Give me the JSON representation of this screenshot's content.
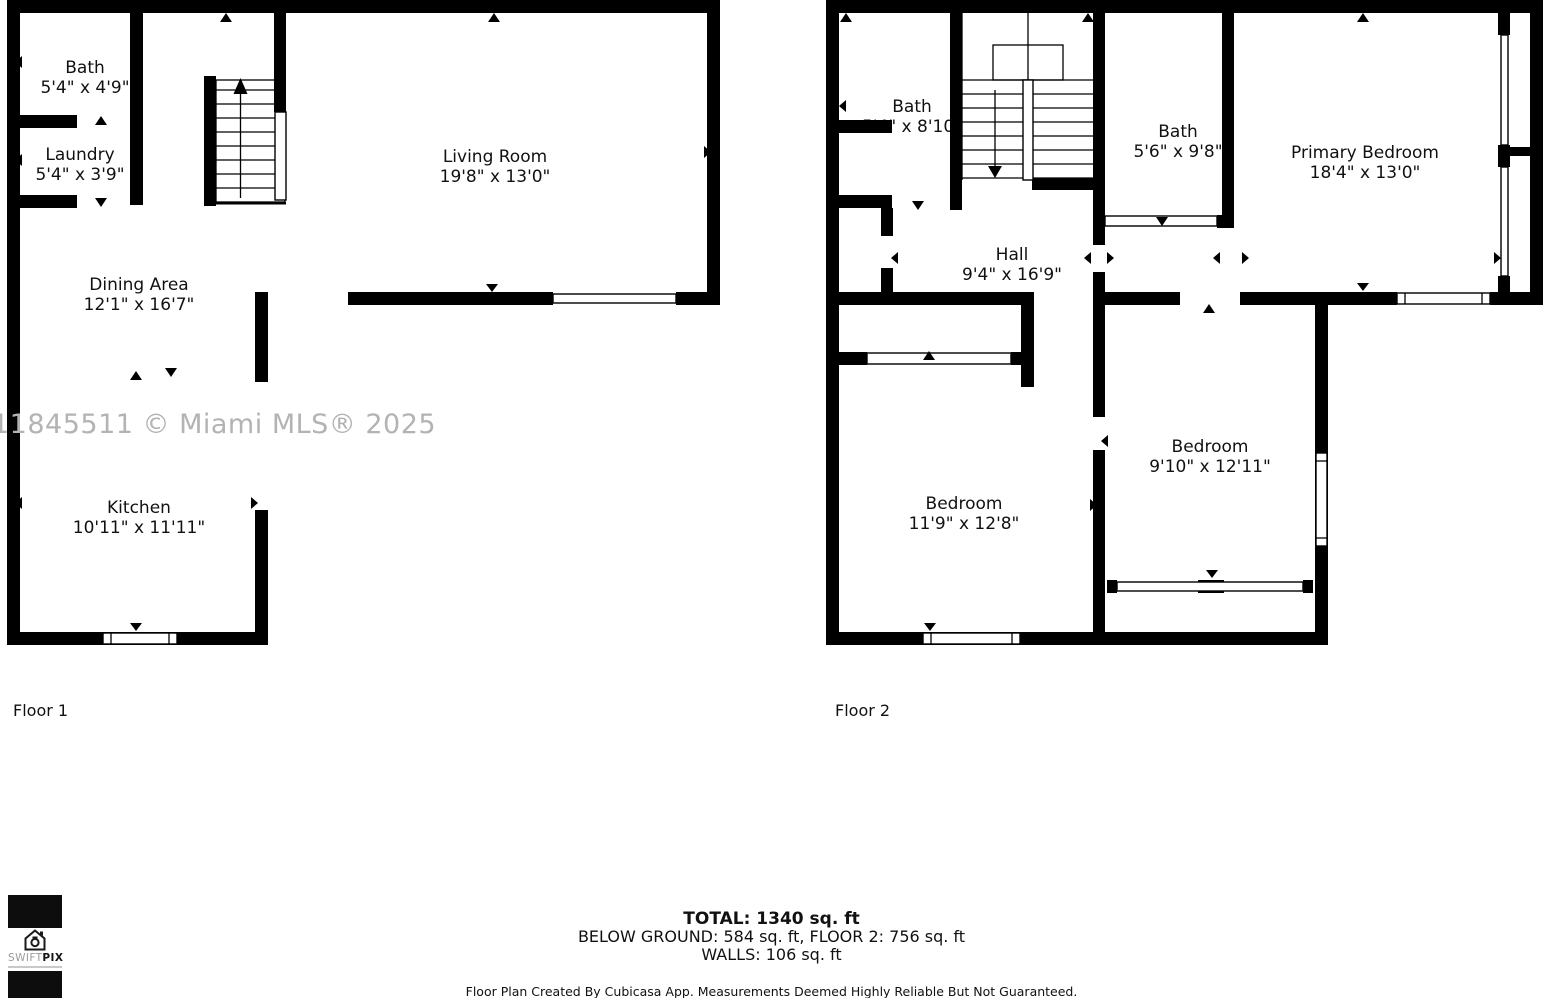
{
  "watermark": "11845511 © Miami MLS® 2025",
  "floors": [
    {
      "label": "Floor 1",
      "rooms": [
        {
          "name": "Bath",
          "dims": "5'4\" x 4'9\""
        },
        {
          "name": "Laundry",
          "dims": "5'4\" x 3'9\""
        },
        {
          "name": "Living Room",
          "dims": "19'8\" x 13'0\""
        },
        {
          "name": "Dining Area",
          "dims": "12'1\" x 16'7\""
        },
        {
          "name": "Kitchen",
          "dims": "10'11\" x 11'11\""
        }
      ]
    },
    {
      "label": "Floor 2",
      "rooms": [
        {
          "name": "Bath",
          "dims": "5'4\" x 8'10\""
        },
        {
          "name": "Bath",
          "dims": "5'6\" x 9'8\""
        },
        {
          "name": "Primary Bedroom",
          "dims": "18'4\" x 13'0\""
        },
        {
          "name": "Hall",
          "dims": "9'4\" x 16'9\""
        },
        {
          "name": "Bedroom",
          "dims": "11'9\" x 12'8\""
        },
        {
          "name": "Bedroom",
          "dims": "9'10\" x 12'11\""
        }
      ]
    }
  ],
  "summary": {
    "total": "TOTAL: 1340 sq. ft",
    "breakdown": "BELOW GROUND: 584 sq. ft, FLOOR 2: 756 sq. ft",
    "walls": "WALLS: 106 sq. ft",
    "disclaimer": "Floor Plan Created By Cubicasa App. Measurements Deemed Highly Reliable But Not Guaranteed."
  },
  "logo": {
    "brand_light": "SWIFT",
    "brand_bold": "PIX"
  },
  "colors": {
    "wall": "#000000",
    "watermark": "#b3b3b3",
    "background": "#ffffff"
  }
}
